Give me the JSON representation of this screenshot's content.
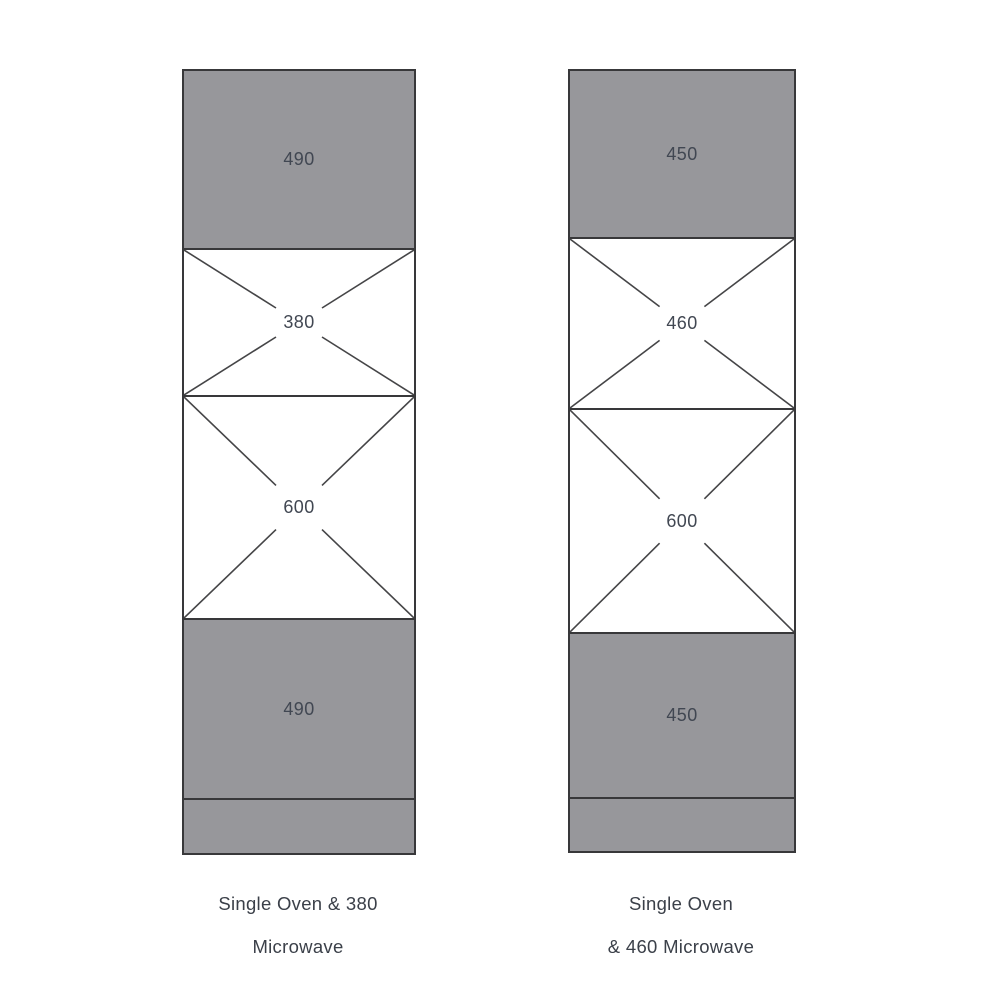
{
  "diagram": {
    "type": "cabinet-elevation",
    "units": "mm",
    "colors": {
      "background": "#ffffff",
      "panel_fill": "#97979b",
      "outline": "#38383a",
      "label_text": "#414752",
      "caption_text": "#3b4049"
    },
    "cabinets": [
      {
        "id": "single-oven-380-microwave",
        "caption_lines": [
          "Single Oven & 380",
          "Microwave"
        ],
        "sections": [
          {
            "kind": "filled-panel",
            "label": "490"
          },
          {
            "kind": "appliance-aperture",
            "label": "380"
          },
          {
            "kind": "appliance-aperture",
            "label": "600"
          },
          {
            "kind": "filled-panel",
            "label": "490"
          },
          {
            "kind": "plinth",
            "label": ""
          }
        ]
      },
      {
        "id": "single-oven-460-microwave",
        "caption_lines": [
          "Single Oven",
          "& 460 Microwave"
        ],
        "sections": [
          {
            "kind": "filled-panel",
            "label": "450"
          },
          {
            "kind": "appliance-aperture",
            "label": "460"
          },
          {
            "kind": "appliance-aperture",
            "label": "600"
          },
          {
            "kind": "filled-panel",
            "label": "450"
          },
          {
            "kind": "plinth",
            "label": ""
          }
        ]
      }
    ]
  }
}
